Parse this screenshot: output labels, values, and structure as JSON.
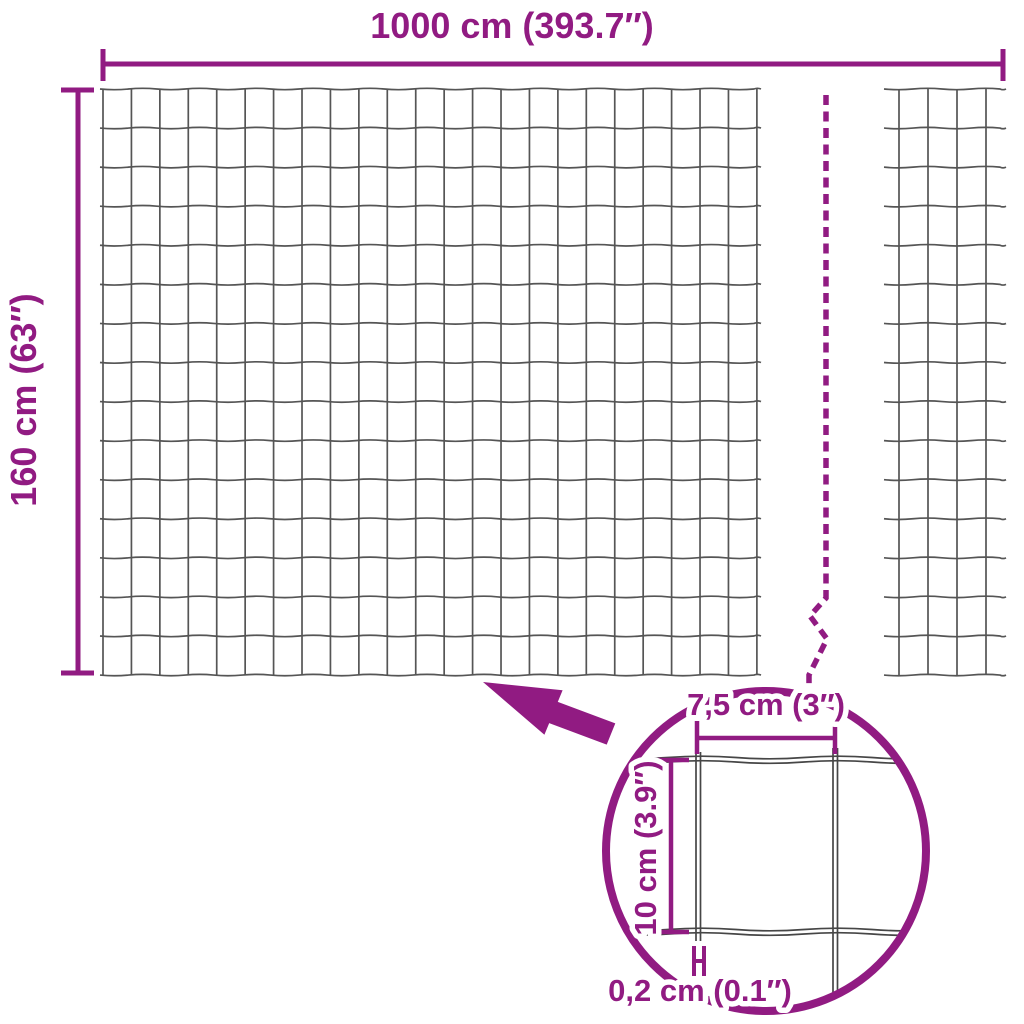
{
  "colors": {
    "accent": "#911b82",
    "wire": "#555555",
    "detail_wire": "#464646",
    "background": "#ffffff"
  },
  "dimensions": {
    "total_width": {
      "label": "1000 cm (393.7″)"
    },
    "total_height": {
      "label": "160 cm (63″)"
    }
  },
  "detail_view": {
    "cell_width": {
      "label": "7,5 cm (3″)"
    },
    "cell_height": {
      "label": "10 cm (3.9″)"
    },
    "wire_thickness": {
      "label": "0,2 cm (0.1″)"
    }
  }
}
